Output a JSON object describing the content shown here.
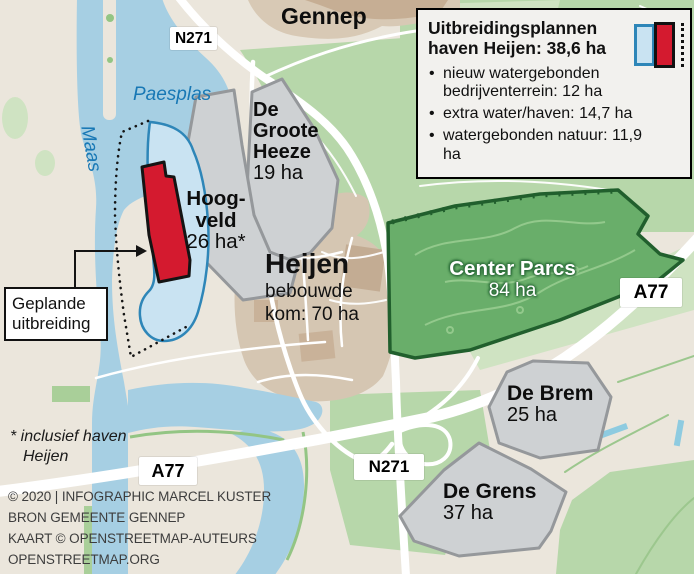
{
  "legend": {
    "title": "Uitbreidingsplannen haven Heijen: 38,6 ha",
    "items": [
      "nieuw watergebonden bedrijventerrein: 12 ha",
      "extra water/haven: 14,7 ha",
      "watergebonden natuur: 11,9 ha"
    ]
  },
  "callout": {
    "text": "Geplande uitbreiding"
  },
  "footnote": {
    "text": "* inclusief haven Heijen"
  },
  "credits": {
    "lines": [
      "© 2020 | INFOGRAPHIC MARCEL KUSTER",
      "BRON GEMEENTE GENNEP",
      "KAART © OPENSTREETMAP-AUTEURS",
      "OPENSTREETMAP.ORG"
    ]
  },
  "signs": {
    "n271_top": "N271",
    "a77_right": "A77",
    "a77_southwest": "A77",
    "n271_south": "N271"
  },
  "places": {
    "gennep": "Gennep",
    "paesplas": "Paesplas",
    "maas": "Maas",
    "heijen": {
      "name": "Heijen",
      "detail": "bebouwde kom: 70 ha"
    },
    "groote_heeze": {
      "name": "De Groote Heeze",
      "area": "19 ha"
    },
    "hoogveld": {
      "name": "Hoog-veld",
      "area": "26 ha*"
    },
    "center_parcs": {
      "name": "Center Parcs",
      "area": "84 ha"
    },
    "de_brem": {
      "name": "De Brem",
      "area": "25 ha"
    },
    "de_grens": {
      "name": "De Grens",
      "area": "37 ha"
    }
  },
  "colors": {
    "land": "#ebe6dc",
    "water": "#a6cfe3",
    "light_green": "#b7d7aa",
    "center_parcs_fill": "#69ae6a",
    "center_parcs_border": "#215f2d",
    "industrial_gray_fill": "#ced1d3",
    "industrial_gray_border": "#95989b",
    "plan_red": "#d41a2f",
    "plan_water_fill": "#c9e3f2",
    "plan_water_border": "#2e86b8",
    "builtup_tan": "#d5c6b2",
    "water_label_blue": "#1878b5"
  }
}
